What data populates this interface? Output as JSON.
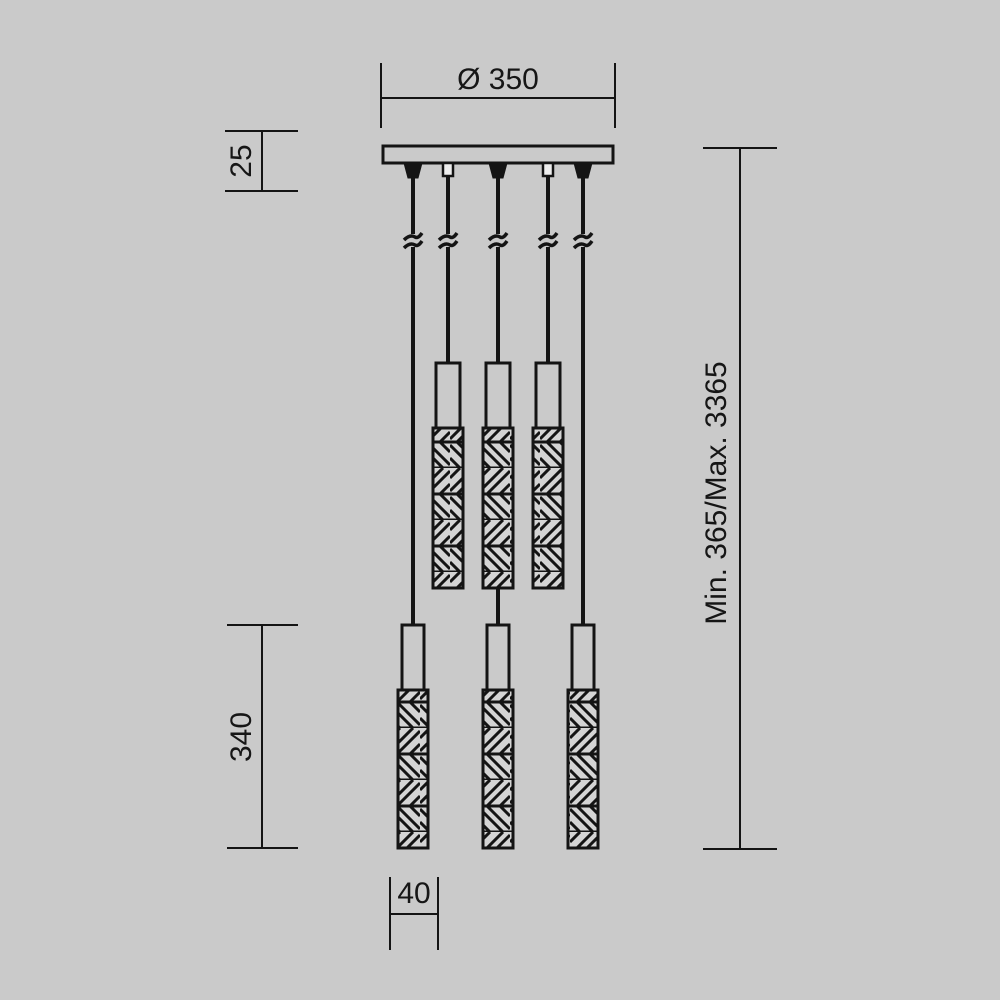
{
  "page": {
    "background_color": "#cacaca",
    "line_color": "#141414",
    "crystal_fill_color": "#d4d4d4"
  },
  "drawing": {
    "dimensions": {
      "canopy_diameter": "Ø 350",
      "canopy_height": "25",
      "shade_length": "340",
      "shade_diameter": "40",
      "suspension_height": "Min. 365/Max. 3365"
    }
  }
}
